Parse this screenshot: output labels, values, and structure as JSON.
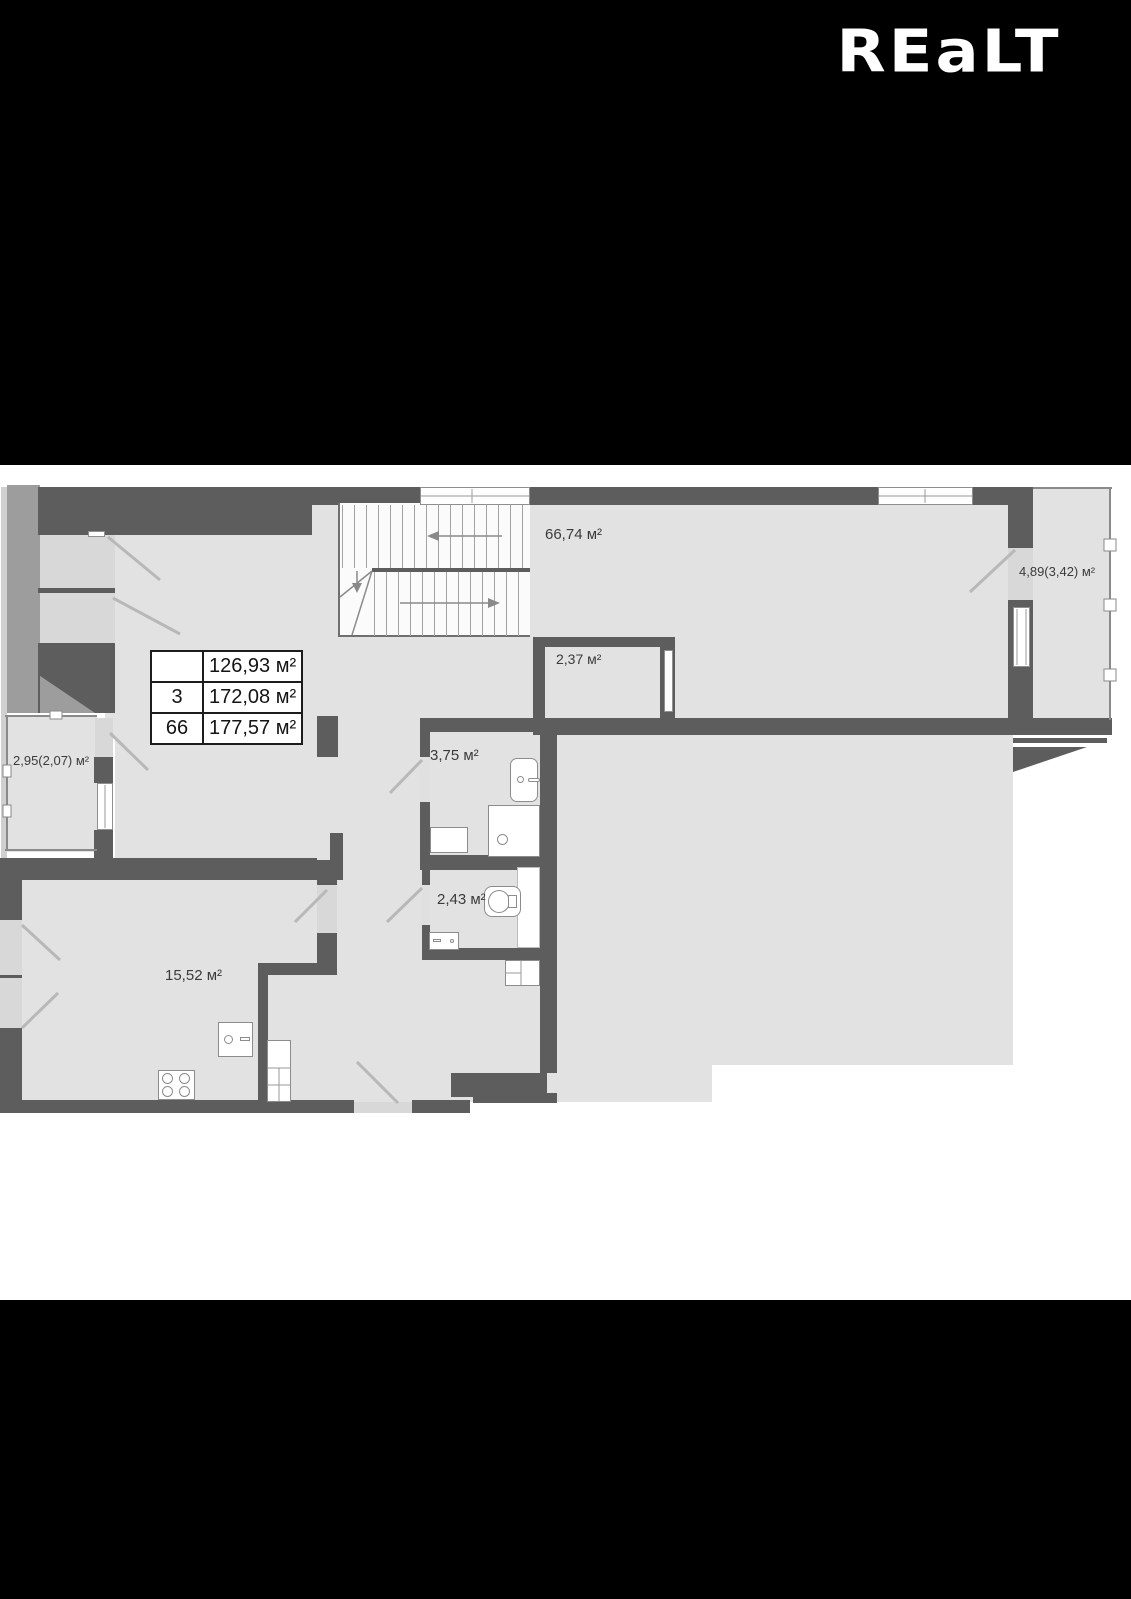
{
  "logo": {
    "text": "REaLT"
  },
  "plan": {
    "area_table": {
      "rows": [
        {
          "num": "",
          "value": "126,93 м²"
        },
        {
          "num": "3",
          "value": "172,08 м²"
        },
        {
          "num": "66",
          "value": "177,57 м²"
        }
      ]
    },
    "rooms": {
      "hall": "66,74 м²",
      "loggia_right": "4,89(3,42) м²",
      "storage": "2,37 м²",
      "loggia_left": "2,95(2,07) м²",
      "bathroom": "3,75 м²",
      "wc": "2,43 м²",
      "kitchen": "15,52 м²"
    },
    "colors": {
      "background": "#000000",
      "canvas": "#ffffff",
      "wall": "#5d5d5d",
      "floor": "#e2e2e2",
      "opening": "#d8d8d8",
      "service_strip": "#9d9d9d"
    }
  }
}
